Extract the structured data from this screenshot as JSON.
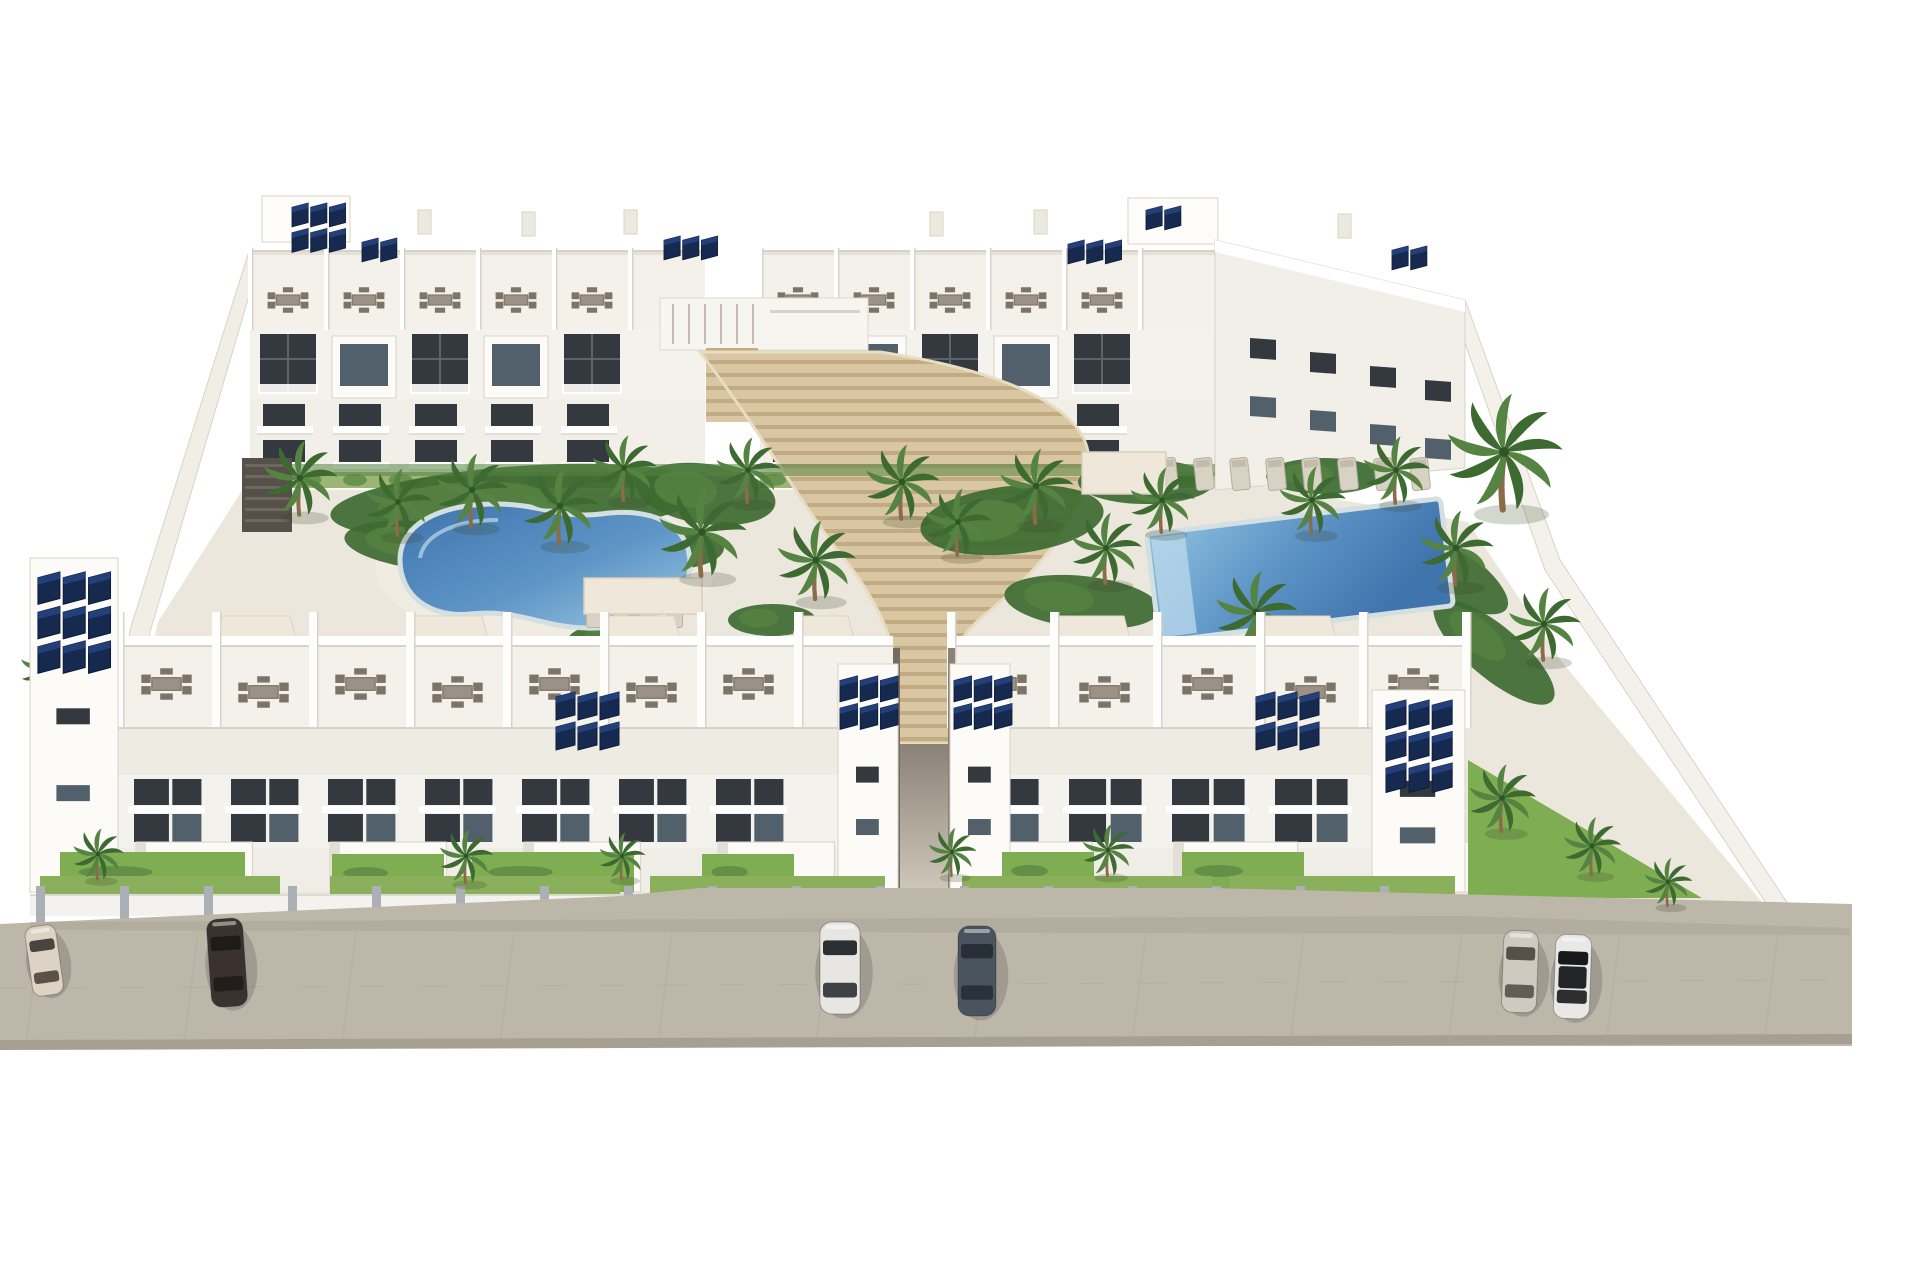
{
  "scene_type": "architectural-3d-render-aerial",
  "palette": {
    "bg": "#ffffff",
    "building_white": "#fafaf6",
    "building_face": "#f4f2ec",
    "building_shade": "#e3dfd6",
    "parapet_line": "#d8d3ca",
    "window_dark": "#33393f",
    "window_glass": "#51606a",
    "terrace_floor": "#f4f1ea",
    "midroof": "#eeebe3",
    "courtyard_base": "#ebe7dd",
    "path_light": "#f0ece2",
    "green_dark": "#3d6a31",
    "green_mid": "#558341",
    "green_bright": "#7fae52",
    "hedge": "#9cb573",
    "trunk": "#8a6b4a",
    "pool_deep": "#3f74ad",
    "pool_pale": "#9cc9e4",
    "pool_rim": "#d4dfe2",
    "stair_light": "#d9c7a3",
    "stair_dark": "#c2ab82",
    "street": "#bdb7aa",
    "street_seam": "#aba595",
    "street_edge": "#a79f92",
    "fence_rail": "#f3f2ee",
    "pillar": "#aab0b6",
    "solar_dark": "#16294f",
    "solar_mid": "#24407a",
    "solar_edge": "#0e1c3a",
    "furniture": "#978d80",
    "furniture_dark": "#6f675c",
    "canopy": "#efe8da",
    "shadow": "rgba(40,40,35,0.18)"
  },
  "back_blocks": [
    {
      "x": 250,
      "w": 455,
      "unit": 76
    },
    {
      "x": 760,
      "w": 455,
      "unit": 76
    }
  ],
  "roof_boxes": [
    {
      "x": 262,
      "y": 196,
      "w": 88,
      "h": 46
    },
    {
      "x": 1128,
      "y": 198,
      "w": 90,
      "h": 46
    }
  ],
  "chimneys": [
    {
      "x": 418,
      "y": 210
    },
    {
      "x": 522,
      "y": 212
    },
    {
      "x": 624,
      "y": 210
    },
    {
      "x": 930,
      "y": 212
    },
    {
      "x": 1034,
      "y": 210
    },
    {
      "x": 1338,
      "y": 214
    }
  ],
  "front_blocks": [
    {
      "x": 118,
      "w": 775,
      "unit": 97
    },
    {
      "x": 950,
      "w": 515,
      "unit": 103
    }
  ],
  "front_towers": [
    {
      "x": 30,
      "y": 558,
      "w": 88,
      "h": 334
    },
    {
      "x": 838,
      "y": 664,
      "w": 60,
      "h": 228
    },
    {
      "x": 950,
      "y": 664,
      "w": 60,
      "h": 228
    },
    {
      "x": 1372,
      "y": 690,
      "w": 93,
      "h": 202
    }
  ],
  "solar_arrays": [
    {
      "x": 292,
      "y": 203,
      "cols": 3,
      "rows": 2,
      "s": 0.85
    },
    {
      "x": 362,
      "y": 238,
      "cols": 2,
      "rows": 1,
      "s": 0.85
    },
    {
      "x": 664,
      "y": 236,
      "cols": 3,
      "rows": 1,
      "s": 0.85
    },
    {
      "x": 1068,
      "y": 240,
      "cols": 3,
      "rows": 1,
      "s": 0.85
    },
    {
      "x": 1146,
      "y": 206,
      "cols": 2,
      "rows": 1,
      "s": 0.85
    },
    {
      "x": 1392,
      "y": 246,
      "cols": 2,
      "rows": 1,
      "s": 0.85
    },
    {
      "x": 38,
      "y": 572,
      "cols": 3,
      "rows": 3,
      "s": 1.15
    },
    {
      "x": 556,
      "y": 692,
      "cols": 3,
      "rows": 2,
      "s": 1.0
    },
    {
      "x": 840,
      "y": 676,
      "cols": 3,
      "rows": 2,
      "s": 0.92
    },
    {
      "x": 954,
      "y": 676,
      "cols": 3,
      "rows": 2,
      "s": 0.92
    },
    {
      "x": 1256,
      "y": 692,
      "cols": 3,
      "rows": 2,
      "s": 1.0
    },
    {
      "x": 1386,
      "y": 700,
      "cols": 3,
      "rows": 3,
      "s": 1.05
    }
  ],
  "pergolas": [
    {
      "x": 212,
      "w": 88
    },
    {
      "x": 404,
      "w": 88
    },
    {
      "x": 596,
      "w": 88
    },
    {
      "x": 788,
      "w": 70
    },
    {
      "x": 1046,
      "w": 88
    },
    {
      "x": 1252,
      "w": 88
    }
  ],
  "palms": [
    {
      "x": 300,
      "y": 478,
      "s": 0.8
    },
    {
      "x": 398,
      "y": 502,
      "s": 0.72
    },
    {
      "x": 472,
      "y": 490,
      "s": 0.78
    },
    {
      "x": 560,
      "y": 506,
      "s": 0.82
    },
    {
      "x": 624,
      "y": 468,
      "s": 0.7
    },
    {
      "x": 702,
      "y": 532,
      "s": 0.95
    },
    {
      "x": 748,
      "y": 470,
      "s": 0.7
    },
    {
      "x": 816,
      "y": 560,
      "s": 0.85
    },
    {
      "x": 902,
      "y": 482,
      "s": 0.8
    },
    {
      "x": 958,
      "y": 522,
      "s": 0.72
    },
    {
      "x": 1036,
      "y": 486,
      "s": 0.8
    },
    {
      "x": 1106,
      "y": 548,
      "s": 0.76
    },
    {
      "x": 1162,
      "y": 500,
      "s": 0.7
    },
    {
      "x": 1256,
      "y": 612,
      "s": 0.88
    },
    {
      "x": 1312,
      "y": 500,
      "s": 0.72
    },
    {
      "x": 1396,
      "y": 470,
      "s": 0.72
    },
    {
      "x": 1456,
      "y": 548,
      "s": 0.8
    },
    {
      "x": 1504,
      "y": 452,
      "s": 1.25
    },
    {
      "x": 1544,
      "y": 624,
      "s": 0.78
    },
    {
      "x": 286,
      "y": 736,
      "s": 1.0
    },
    {
      "x": 204,
      "y": 762,
      "s": 0.7
    },
    {
      "x": 98,
      "y": 854,
      "s": 0.55
    },
    {
      "x": 466,
      "y": 856,
      "s": 0.58
    },
    {
      "x": 622,
      "y": 856,
      "s": 0.5
    },
    {
      "x": 952,
      "y": 852,
      "s": 0.52
    },
    {
      "x": 1108,
      "y": 850,
      "s": 0.56
    },
    {
      "x": 1502,
      "y": 798,
      "s": 0.72
    },
    {
      "x": 1592,
      "y": 846,
      "s": 0.62
    },
    {
      "x": 1668,
      "y": 882,
      "s": 0.52
    },
    {
      "x": 48,
      "y": 668,
      "s": 0.6
    }
  ],
  "green_patches": [
    {
      "cx": 520,
      "cy": 502,
      "rx": 190,
      "ry": 36,
      "rot": -4
    },
    {
      "cx": 428,
      "cy": 546,
      "rx": 84,
      "ry": 24,
      "rot": 6
    },
    {
      "cx": 666,
      "cy": 548,
      "rx": 58,
      "ry": 22,
      "rot": 0
    },
    {
      "cx": 706,
      "cy": 494,
      "rx": 70,
      "ry": 30,
      "rot": 8
    },
    {
      "cx": 1012,
      "cy": 520,
      "rx": 92,
      "ry": 34,
      "rot": -6
    },
    {
      "cx": 1082,
      "cy": 602,
      "rx": 78,
      "ry": 26,
      "rot": 6
    },
    {
      "cx": 1146,
      "cy": 482,
      "rx": 68,
      "ry": 22,
      "rot": 0
    },
    {
      "cx": 1324,
      "cy": 476,
      "rx": 58,
      "ry": 18,
      "rot": 0
    },
    {
      "cx": 1432,
      "cy": 562,
      "rx": 88,
      "ry": 28,
      "rot": 32
    },
    {
      "cx": 1494,
      "cy": 652,
      "rx": 76,
      "ry": 26,
      "rot": 40
    },
    {
      "cx": 624,
      "cy": 640,
      "rx": 56,
      "ry": 18,
      "rot": 0
    },
    {
      "cx": 772,
      "cy": 620,
      "rx": 44,
      "ry": 16,
      "rot": 0
    }
  ],
  "grass_strips": [
    {
      "x": 40,
      "w": 240
    },
    {
      "x": 330,
      "w": 290
    },
    {
      "x": 650,
      "w": 235
    },
    {
      "x": 962,
      "w": 250
    },
    {
      "x": 1230,
      "w": 225
    }
  ],
  "garden_patches": [
    {
      "x": 60,
      "y": 852,
      "w": 185,
      "h": 40
    },
    {
      "x": 332,
      "y": 854,
      "w": 112,
      "h": 38
    },
    {
      "x": 472,
      "y": 852,
      "w": 162,
      "h": 40
    },
    {
      "x": 702,
      "y": 854,
      "w": 92,
      "h": 36
    },
    {
      "x": 1002,
      "y": 852,
      "w": 92,
      "h": 38
    },
    {
      "x": 1182,
      "y": 852,
      "w": 122,
      "h": 38
    }
  ],
  "loungers_right_pool": {
    "x0": 1168,
    "y": 474,
    "dx": 36,
    "count": 8,
    "rot": -6
  },
  "loungers_left_pool": {
    "x0": 594,
    "y": 614,
    "dx": 27,
    "count": 4,
    "rot": 0
  },
  "shade_canopies": [
    {
      "x": 584,
      "y": 578,
      "w": 118,
      "h": 36
    },
    {
      "x": 1082,
      "y": 452,
      "w": 84,
      "h": 42
    }
  ],
  "dark_pergola": {
    "x": 242,
    "y": 458,
    "w": 50,
    "h": 74
  },
  "pools": {
    "left": {
      "deck_cx": 545,
      "deck_cy": 568,
      "deck_rx": 170,
      "deck_ry": 74
    },
    "right": {
      "cx": 1300,
      "cy": 570,
      "w": 296,
      "h": 108,
      "rot": -7
    }
  },
  "fence": {
    "x": 30,
    "w": 1430,
    "y": 894,
    "h": 22,
    "post_gap": 84
  },
  "cars": [
    {
      "x": 24,
      "y": 928,
      "l": 70,
      "w": 31,
      "body": "#ddd2c4",
      "glass": "#4a443e",
      "angle": -8
    },
    {
      "x": 206,
      "y": 920,
      "l": 88,
      "w": 36,
      "body": "#3a322e",
      "glass": "#1f1b19",
      "angle": -4
    },
    {
      "x": 820,
      "y": 922,
      "l": 92,
      "w": 40,
      "body": "#e8e6e2",
      "glass": "#2b3035",
      "angle": 0
    },
    {
      "x": 958,
      "y": 926,
      "l": 90,
      "w": 38,
      "body": "#4a545f",
      "glass": "#272e36",
      "angle": 0
    },
    {
      "x": 1504,
      "y": 930,
      "l": 82,
      "w": 35,
      "body": "#cfc9c0",
      "glass": "#56504a",
      "angle": 2
    },
    {
      "x": 1556,
      "y": 934,
      "l": 84,
      "w": 36,
      "body": "#e9e8e6",
      "glass": "#17191c",
      "angle": 2
    }
  ],
  "street": {
    "top_left_y": 924,
    "top_right_y": 904,
    "bottom_y": 1046,
    "x_end": 1852
  },
  "counts": {
    "back_blocks": 2,
    "front_blocks": 2,
    "pools": 2,
    "cars": 6
  }
}
